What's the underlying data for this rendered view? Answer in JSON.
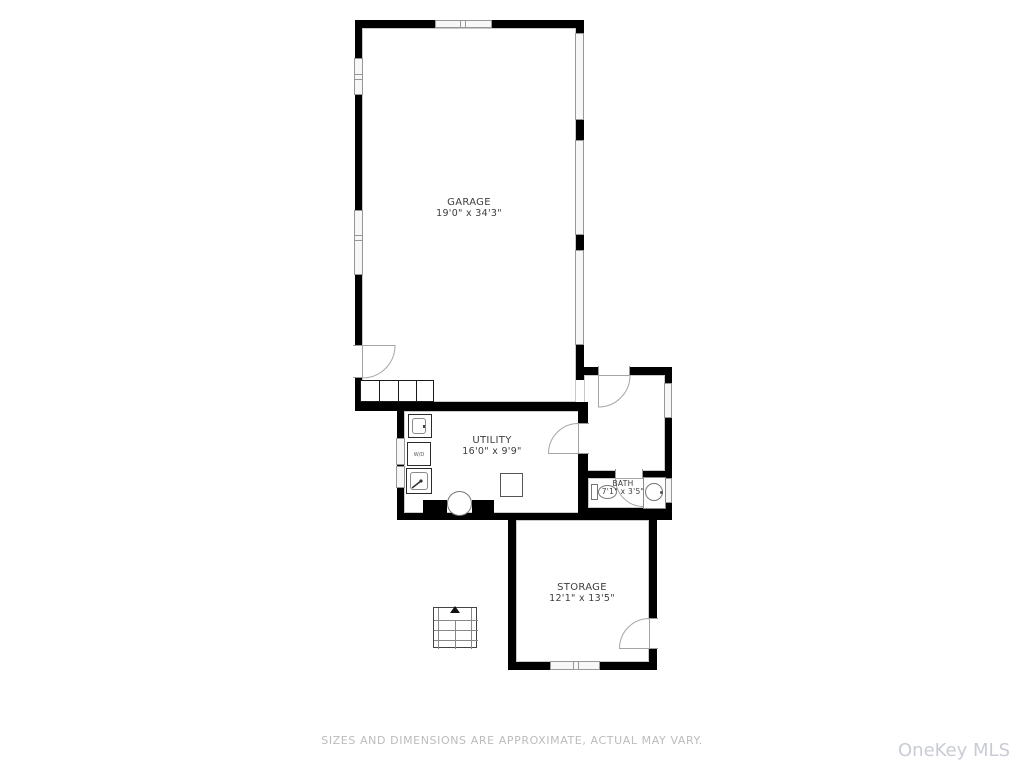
{
  "plan": {
    "rooms": {
      "garage": {
        "name": "GARAGE",
        "dims": "19'0\" x 34'3\""
      },
      "utility": {
        "name": "UTILITY",
        "dims": "16'0\" x 9'9\""
      },
      "bath": {
        "name": "BATH",
        "dims": "7'1\" x 3'5\""
      },
      "storage": {
        "name": "STORAGE",
        "dims": "12'1\" x 13'5\""
      }
    },
    "fixtures": {
      "washer_dryer": "W/D"
    },
    "colors": {
      "wall": "#000000",
      "window_line": "#979797",
      "door_line": "#a5a5a5",
      "label_text": "#3d3d3d",
      "footer_text": "#bcbcbc",
      "watermark_text": "#c9ccd4"
    }
  },
  "footer": {
    "disclaimer": "SIZES AND DIMENSIONS ARE APPROXIMATE, ACTUAL MAY VARY."
  },
  "watermark": {
    "text": "OneKey MLS"
  }
}
